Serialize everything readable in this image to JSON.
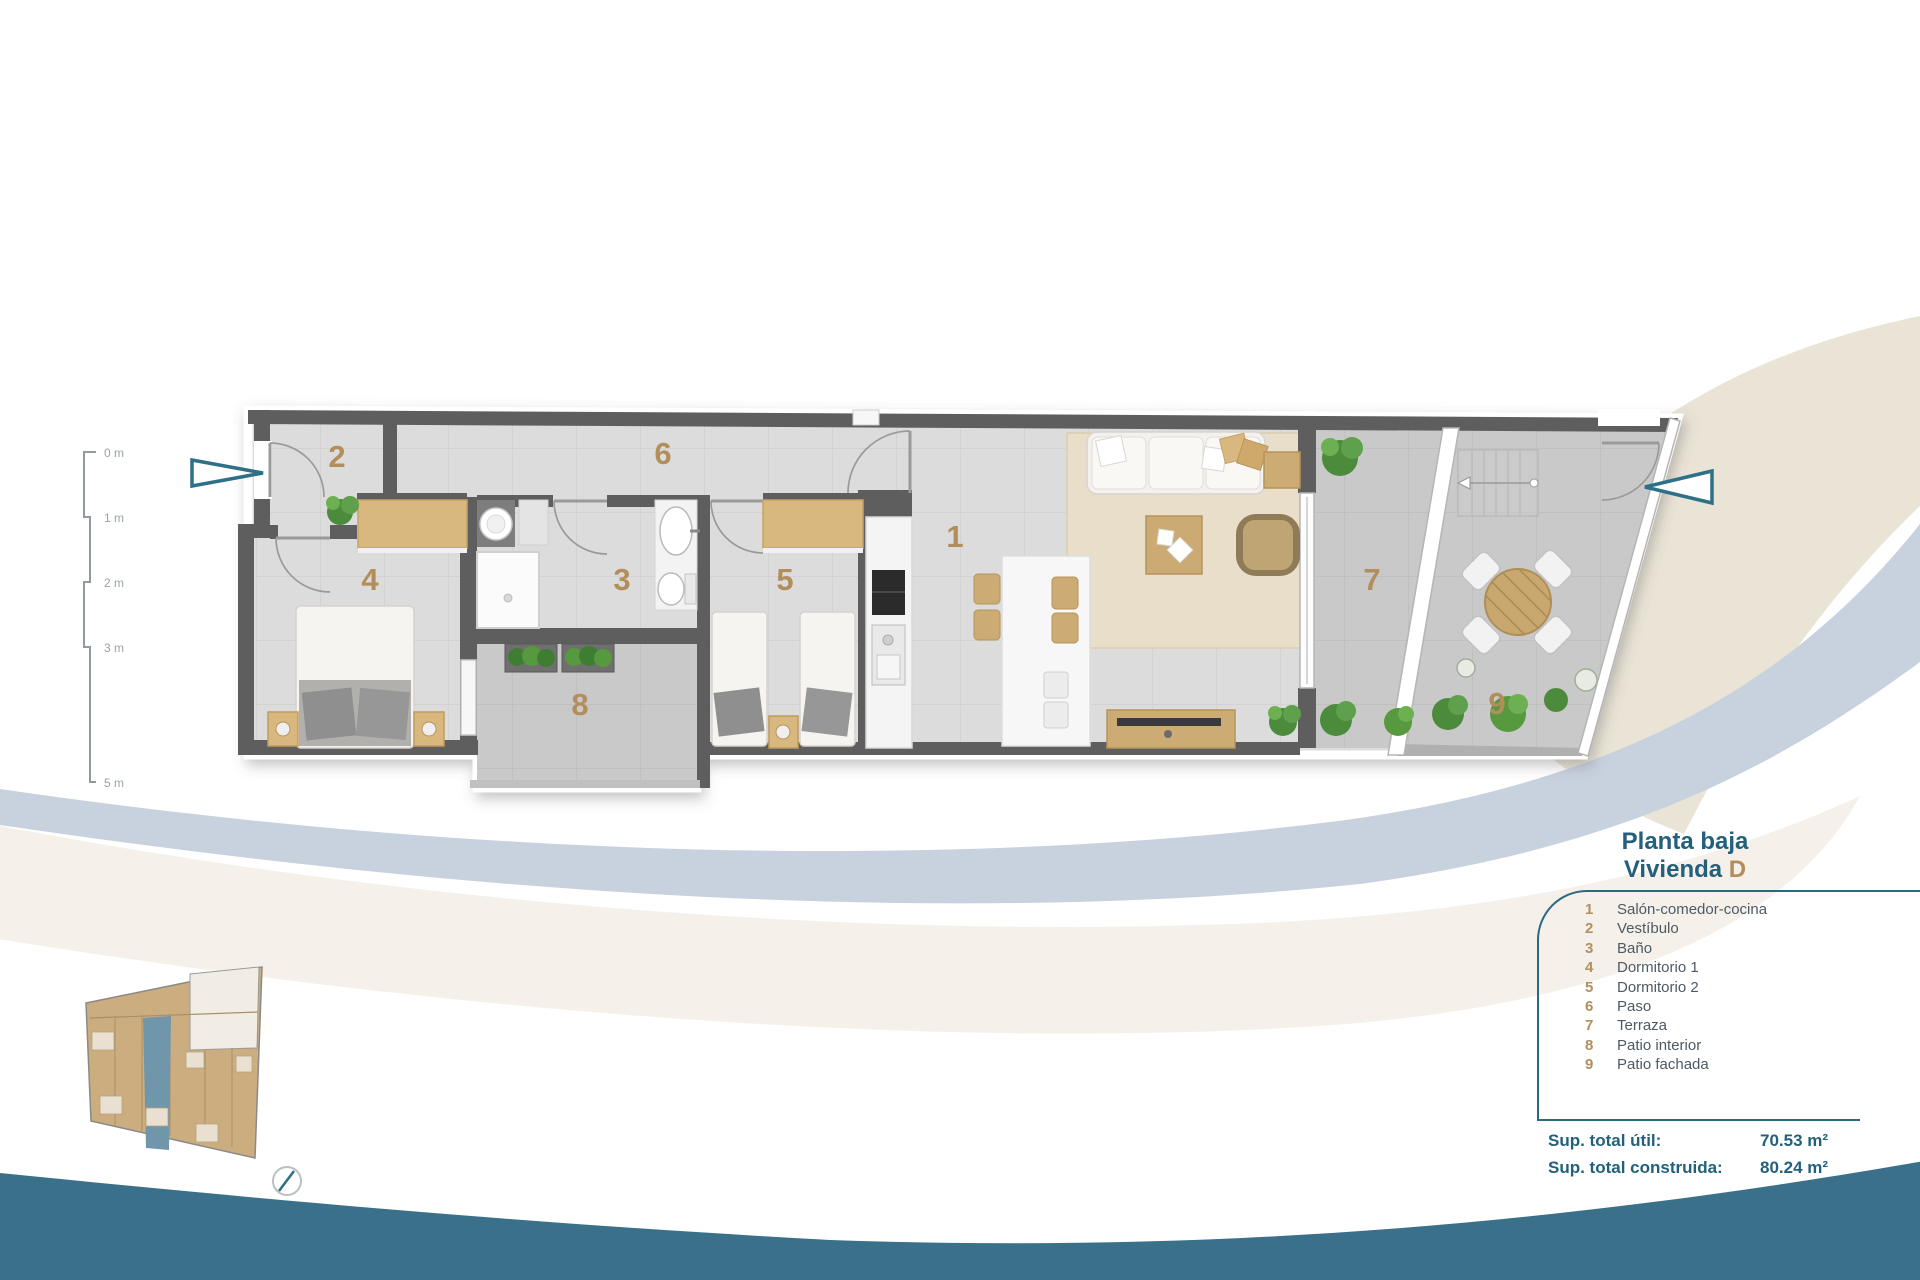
{
  "title": {
    "line1": "Planta baja",
    "line2_label": "Vivienda",
    "line2_unit": "D"
  },
  "legend": {
    "items": [
      {
        "num": "1",
        "label": "Salón-comedor-cocina"
      },
      {
        "num": "2",
        "label": "Vestíbulo"
      },
      {
        "num": "3",
        "label": "Baño"
      },
      {
        "num": "4",
        "label": "Dormitorio 1"
      },
      {
        "num": "5",
        "label": "Dormitorio 2"
      },
      {
        "num": "6",
        "label": "Paso"
      },
      {
        "num": "7",
        "label": "Terraza"
      },
      {
        "num": "8",
        "label": "Patio interior"
      },
      {
        "num": "9",
        "label": "Patio fachada"
      }
    ]
  },
  "totals": {
    "rows": [
      {
        "label": "Sup. total útil:",
        "value": "70.53 m²"
      },
      {
        "label": "Sup. total construida:",
        "value": "80.24 m²"
      }
    ]
  },
  "scale_bar": {
    "ticks": [
      "0 m",
      "1 m",
      "2 m",
      "3 m",
      "5 m"
    ]
  },
  "plan": {
    "room_numbers": [
      "1",
      "2",
      "3",
      "4",
      "5",
      "6",
      "7",
      "8",
      "9"
    ]
  },
  "colors": {
    "accent_teal": "#23607b",
    "accent_tan": "#b28e5c",
    "wave_teal": "#3a7089",
    "wave_blue": "#c8d1de",
    "wave_beige": "#eae4d6",
    "wall_gray": "#5e5e5e",
    "highlight_unit_blue": "#7096ac"
  }
}
